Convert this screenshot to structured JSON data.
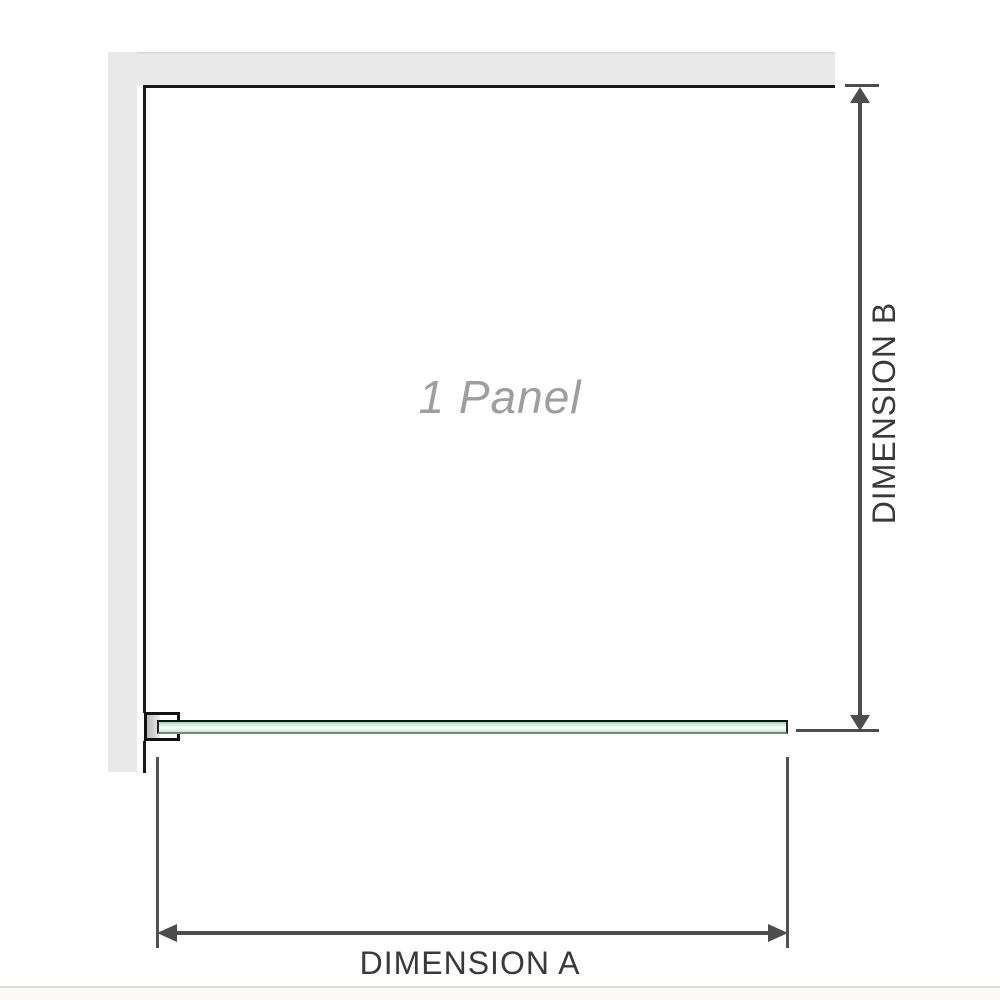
{
  "diagram": {
    "panel_label": "1 Panel",
    "dimension_a_label": "DIMENSION A",
    "dimension_b_label": "DIMENSION B"
  },
  "colors": {
    "wall_gray": "#e9e9e9",
    "panel_outline": "#1a1a1a",
    "dimension_lines": "#4d4d4d",
    "dimension_text": "#3a3a3a",
    "panel_label_gray": "#9e9ea0",
    "glass_green_top": "#9ed7b0",
    "glass_green_light": "#d4efdd",
    "glass_highlight": "#ffffff"
  }
}
